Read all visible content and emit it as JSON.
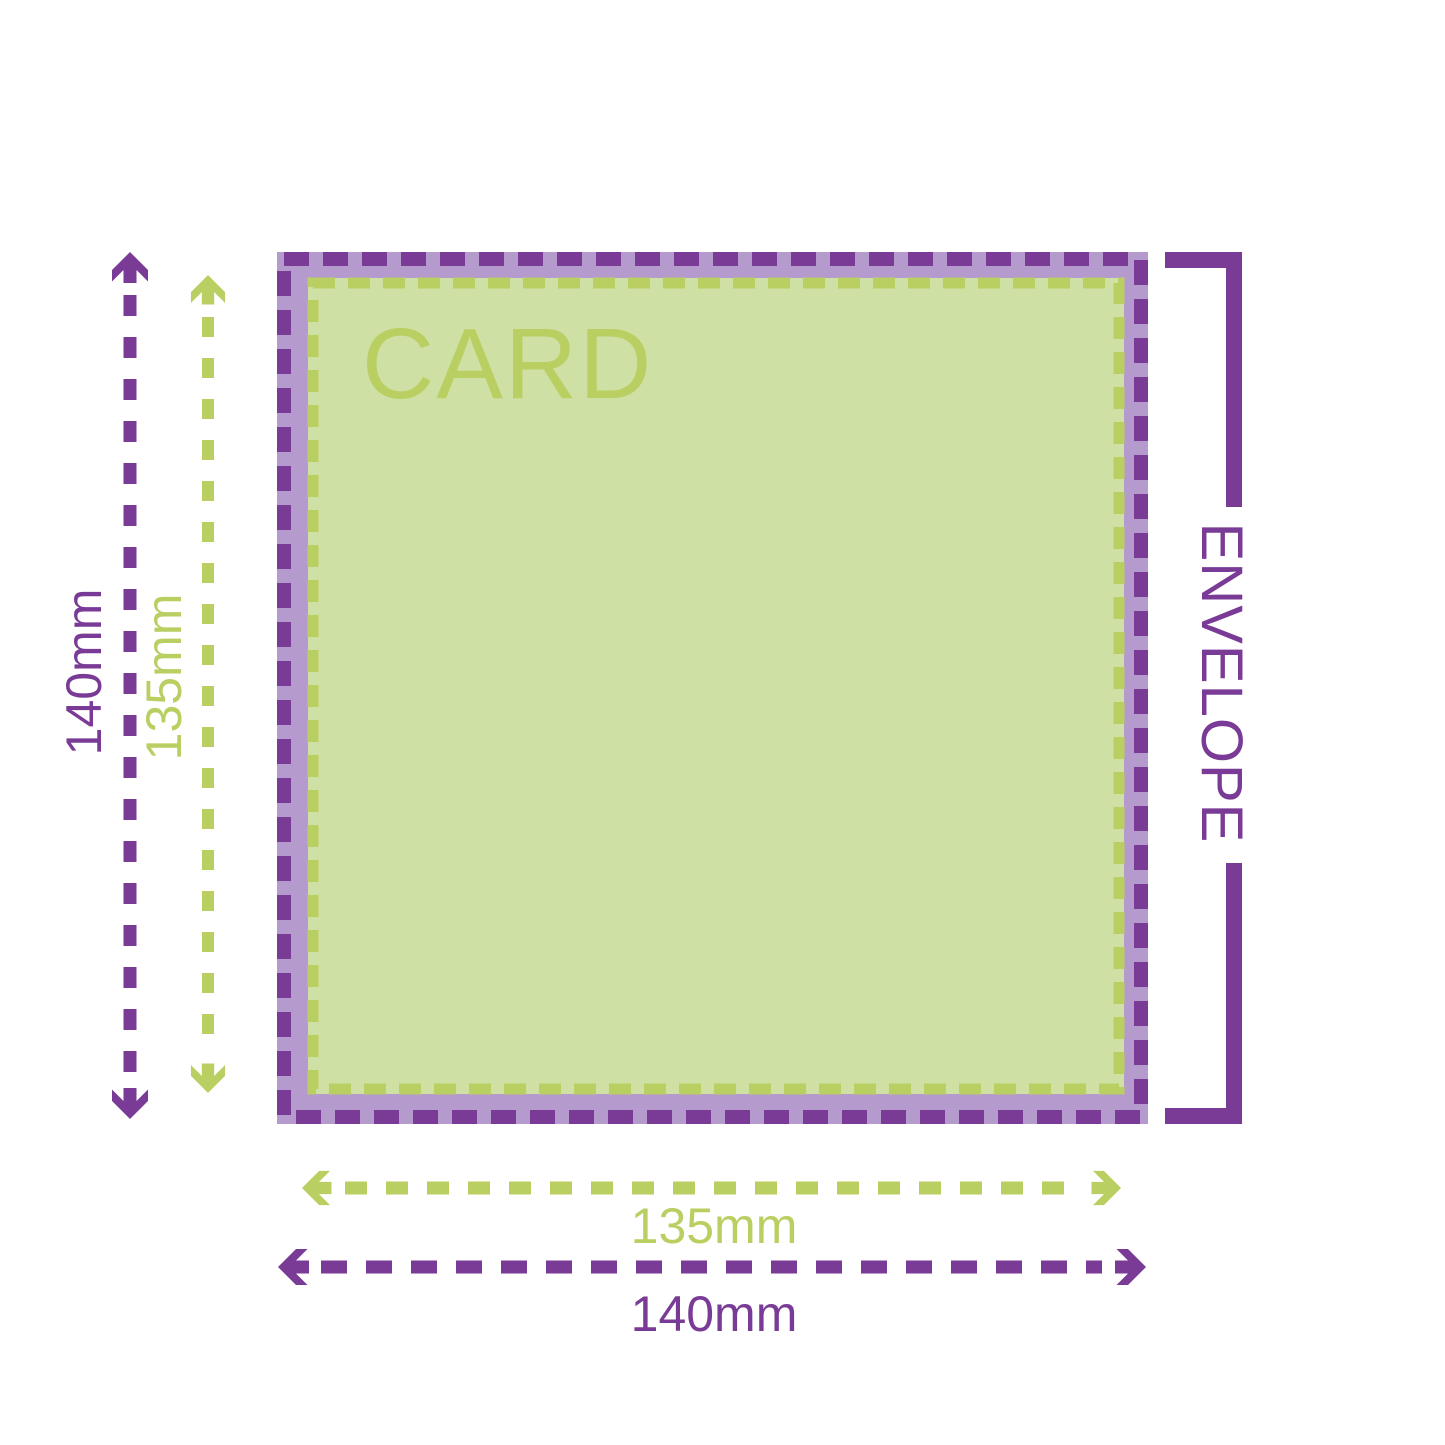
{
  "colors": {
    "purple": "#7a3b96",
    "purple-light": "#b59ace",
    "green": "#b9cf62",
    "green-light": "#cfe0a4"
  },
  "card": {
    "label": "CARD",
    "width_label": "135mm",
    "height_label": "135mm"
  },
  "envelope": {
    "label": "ENVELOPE",
    "width_label": "140mm",
    "height_label": "140mm"
  }
}
